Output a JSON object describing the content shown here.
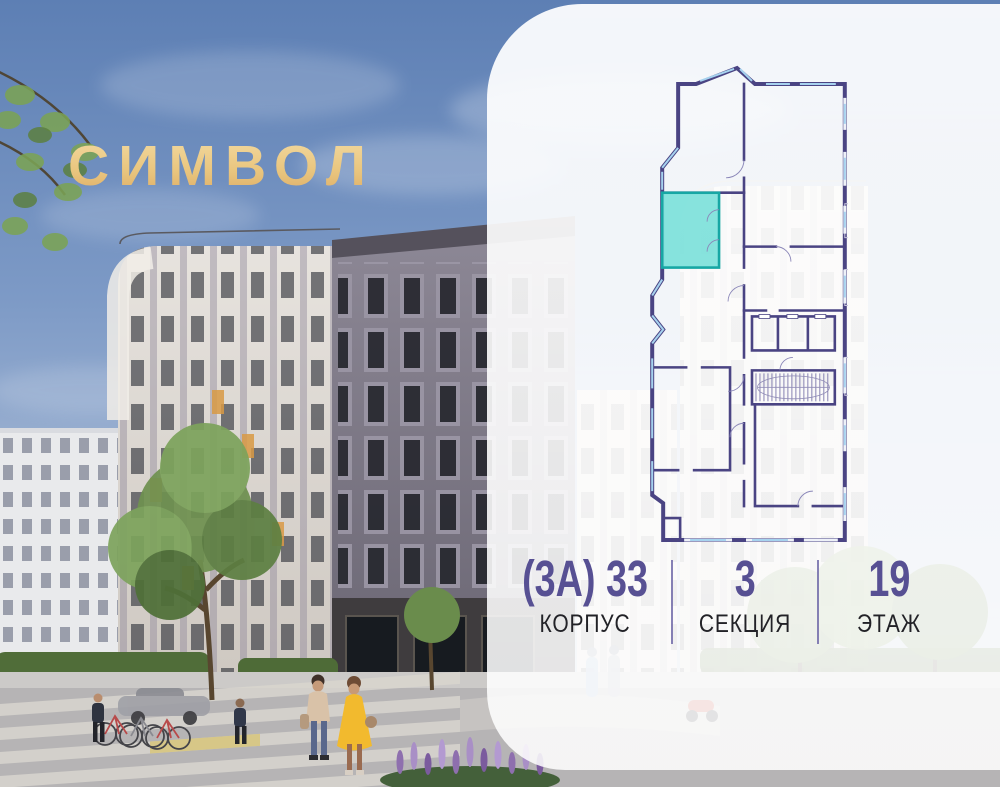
{
  "logo": {
    "text": "СИМВОЛ"
  },
  "info_panel": {
    "building": {
      "value": "(3А) 33",
      "label": "КОРПУС"
    },
    "section": {
      "value": "3",
      "label": "СЕКЦИЯ"
    },
    "floor": {
      "value": "19",
      "label": "ЭТАЖ"
    }
  },
  "floor_plan": {
    "type": "section-floor-plan",
    "highlighted_unit_color": "#7DE1DA",
    "highlighted_unit_border": "#17A7A4",
    "wall_color": "#4A4483",
    "window_color": "#A6D2EF"
  },
  "colors": {
    "panel_bg": "rgba(255,255,255,0.87)",
    "value_purple": "#575093",
    "label_dark": "#222227",
    "divider_purple": "#716BA9",
    "logo_gold_light": "#F4DFAB",
    "logo_gold_dark": "#D8A45E",
    "sky_top": "#5D7FB4"
  }
}
